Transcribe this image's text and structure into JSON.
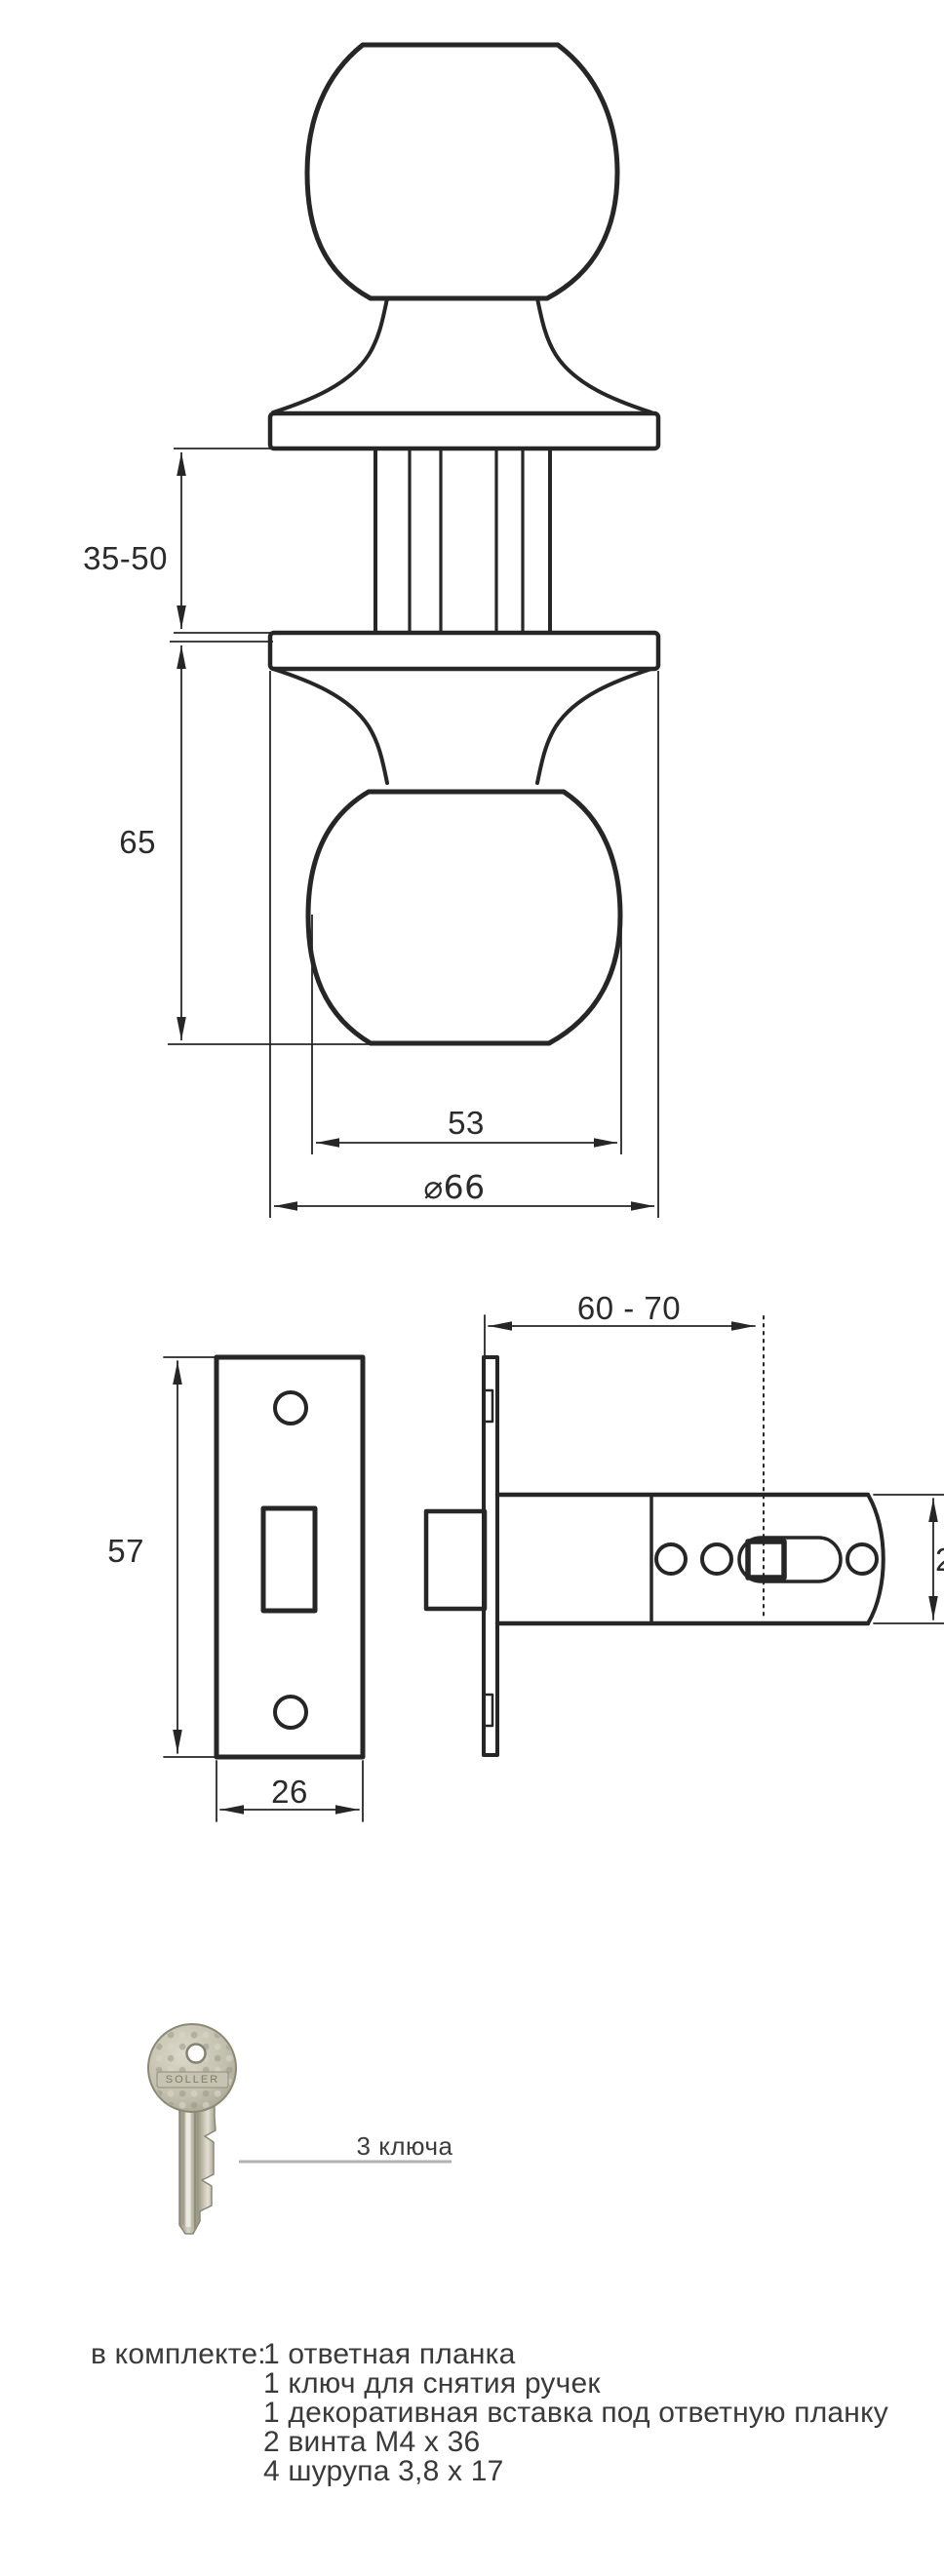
{
  "knob_view": {
    "dim_grip_range": "35-50",
    "dim_knob_projection": "65",
    "dim_knob_width": "53",
    "dim_rose_diameter": "⌀66"
  },
  "latch_view": {
    "dim_backset": "60 - 70",
    "dim_plate_height": "57",
    "dim_plate_width": "26",
    "dim_body_diameter_partial": "2"
  },
  "key": {
    "brand": "SOLLER",
    "count_label": "3 ключа"
  },
  "package": {
    "label": "в комплекте:",
    "items": [
      "1 ответная планка",
      "1 ключ для снятия ручек",
      "1 декоративная вставка под ответную планку",
      "2 винта М4 х 36",
      "4 шурупа 3,8 х 17"
    ]
  },
  "colors": {
    "line": "#262626",
    "leader_line": "#b1b1b1",
    "key_metal": "#c2bfae"
  }
}
